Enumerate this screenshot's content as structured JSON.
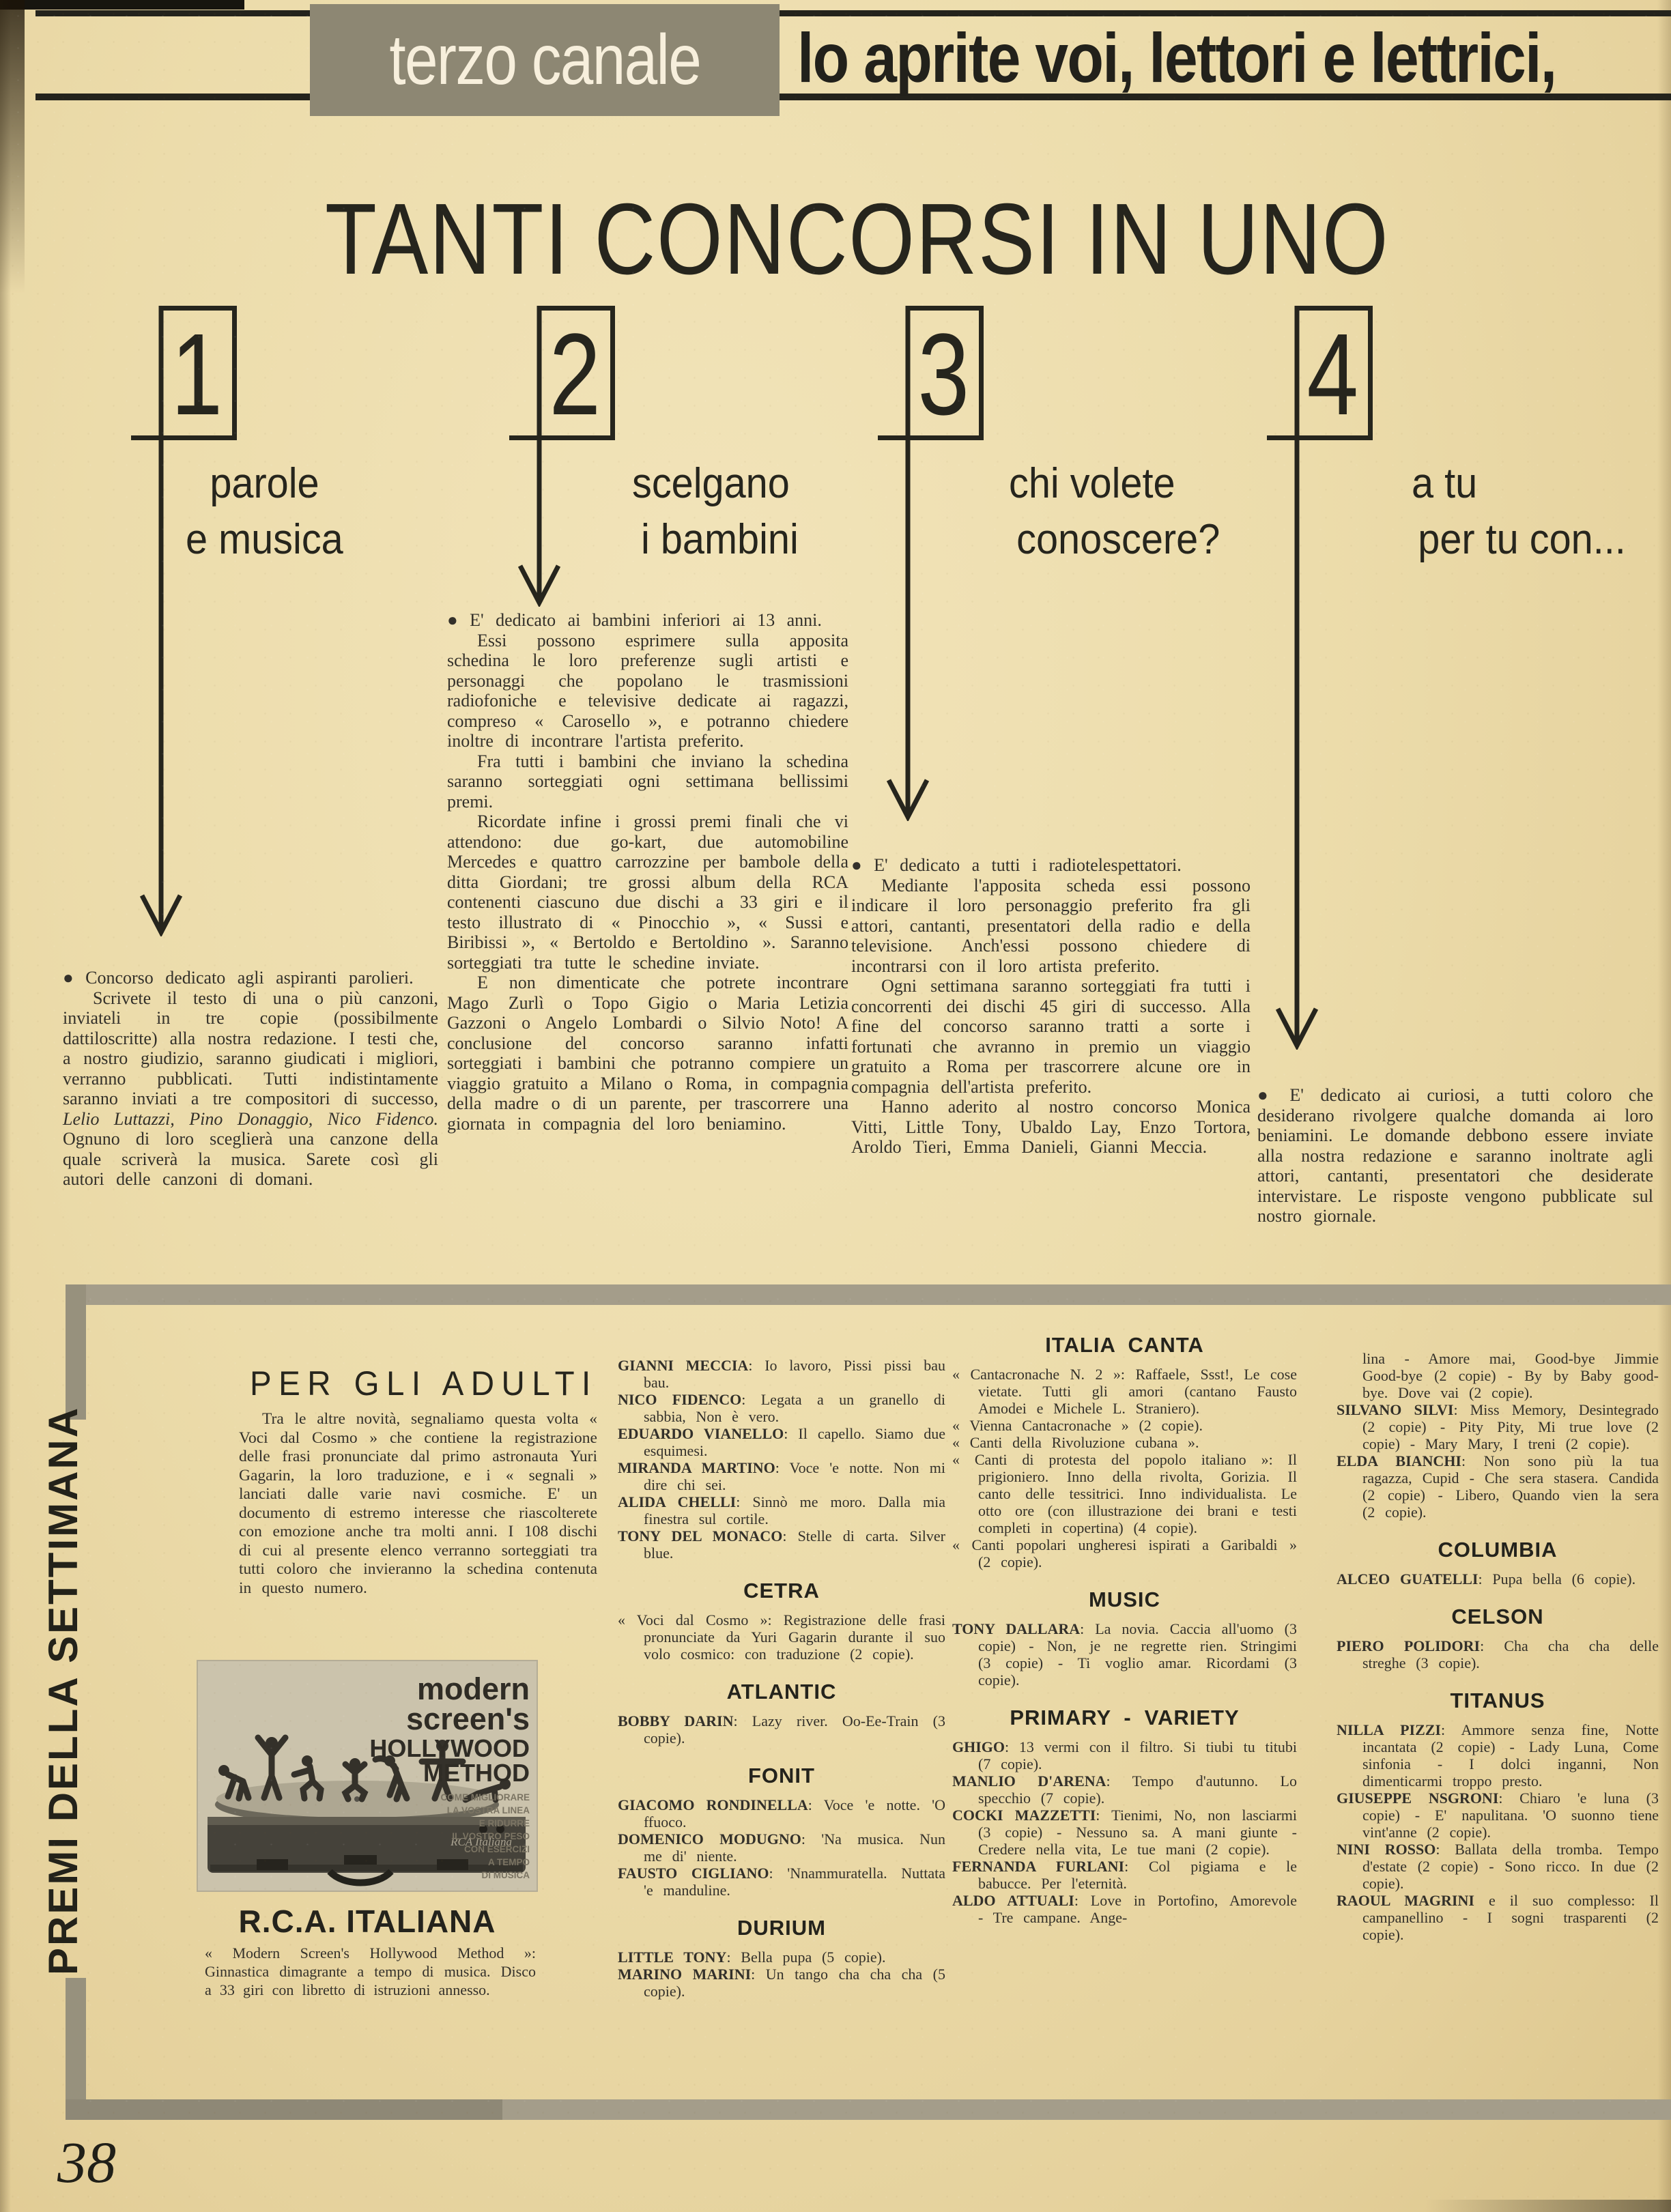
{
  "header": {
    "brand": "terzo canale",
    "tagline": "lo aprite voi, lettori e lettrici,"
  },
  "title": "TANTI CONCORSI IN UNO",
  "concorsi": [
    {
      "number": "1",
      "heading": [
        "parole",
        "e musica"
      ],
      "p1": "●  Concorso dedicato agli aspiranti parolieri.",
      "p2a": "Scrivete il testo di una o più canzoni, inviateli in tre copie (possibilmente dattiloscritte) alla nostra redazione. I testi che, a nostro giudizio, saranno giudicati i migliori, verranno pubblicati. Tutti indistintamente saranno inviati a tre compositori di successo, ",
      "p2i": "Lelio Luttazzi, Pino Donaggio, Nico Fidenco.",
      "p2b": " Ognuno di loro sceglierà una canzone della quale scriverà la musica. Sarete così gli autori delle canzoni di domani."
    },
    {
      "number": "2",
      "heading": [
        "scelgano",
        "i bambini"
      ],
      "paragraphs": [
        "●  E' dedicato ai bambini inferiori ai 13 anni.",
        "Essi possono esprimere sulla apposita schedina le loro preferenze sugli artisti e personaggi che popolano le trasmissioni radiofoniche e televisive dedicate ai ragazzi, compreso « Carosello », e potranno chiedere inoltre di incontrare l'artista preferito.",
        "Fra tutti i bambini che inviano la schedina saranno sorteggiati ogni settimana bellissimi premi.",
        "Ricordate infine i grossi premi finali che vi attendono: due go-kart, due automobiline Mercedes e quattro carrozzine per bambole della ditta Giordani; tre grossi album della RCA contenenti ciascuno due dischi a 33 giri e il testo illustrato di « Pinocchio », « Sussi e Biribissi », « Bertoldo e Bertoldino ». Saranno sorteggiati tra tutte le schedine inviate.",
        "E non dimenticate che potrete incontrare Mago Zurlì o Topo Gigio o Maria Letizia Gazzoni o Angelo Lombardi o Silvio Noto! A conclusione del concorso saranno infatti sorteggiati i bambini che potranno compiere un viaggio gratuito a Milano o Roma, in compagnia della madre o di un parente, per trascorrere una giornata in compagnia del loro beniamino."
      ]
    },
    {
      "number": "3",
      "heading": [
        "chi volete",
        "conoscere?"
      ],
      "paragraphs": [
        "●  E' dedicato a tutti i radiotelespettatori.",
        "Mediante l'apposita scheda essi possono indicare il loro personaggio preferito fra gli attori, cantanti, presentatori della radio e della televisione. Anch'essi possono chiedere di incontrarsi con il loro artista preferito.",
        "Ogni settimana saranno sorteggiati fra tutti i concorrenti dei dischi 45 giri di successo. Alla fine del concorso saranno tratti a sorte i fortunati che avranno in premio un viaggio gratuito a Roma per trascorrere alcune ore in compagnia dell'artista preferito.",
        "Hanno aderito al nostro concorso Monica Vitti, Little Tony, Ubaldo Lay, Enzo Tortora, Aroldo Tieri, Emma Danieli, Gianni Meccia."
      ]
    },
    {
      "number": "4",
      "heading": [
        "a tu",
        "per tu con..."
      ],
      "paragraphs": [
        "●  E' dedicato ai curiosi, a tutti coloro che desiderano rivolgere qualche domanda ai loro beniamini. Le domande debbono essere inviate alla nostra redazione e saranno inoltrate agli attori, cantanti, presentatori che desiderate intervistare. Le risposte vengono pubblicate sul nostro giornale."
      ]
    }
  ],
  "premi": {
    "vertical_title": "PREMI DELLA SETTIMANA",
    "page_number": "38",
    "adulti": {
      "heading": "PER GLI ADULTI",
      "intro": "Tra le altre novità, segnaliamo questa volta « Voci dal Cosmo » che contiene la registrazione delle frasi pronunciate dal primo astronauta Yuri Gagarin, la loro traduzione, e i « segnali » lanciati dalle varie navi cosmiche. E' un documento di estremo interesse che riascolterete con emozione anche tra molti anni. I 108 dischi di cui al presente elenco verranno sorteggiati tra tutti coloro che invieranno la schedina contenuta in questo numero.",
      "cover": {
        "title_lines": [
          "modern",
          "screen's",
          "HOLLYWOOD",
          "METHOD"
        ],
        "subtitle_lines": [
          "COME MIGLIORARE",
          "LA VOSTRA LINEA",
          "E RIDURRE",
          "IL VOSTRO PESO",
          "CON ESERCIZI",
          "A TEMPO",
          "DI MUSICA"
        ],
        "brand_script": "RCA Italiana"
      },
      "label_name": "R.C.A. ITALIANA",
      "caption": "« Modern Screen's Hollywood Method »: Ginnastica dimagrante a tempo di musica. Disco a 33 giri con libretto di istruzioni annesso."
    },
    "col2": {
      "items1": [
        {
          "artist": "GIANNI MECCIA",
          "works": ": Io lavoro, Pissi pissi bau bau."
        },
        {
          "artist": "NICO FIDENCO",
          "works": ": Legata a un granello di sabbia, Non è vero."
        },
        {
          "artist": "EDUARDO VIANELLO",
          "works": ": Il capello. Siamo due esquimesi."
        },
        {
          "artist": "MIRANDA MARTINO",
          "works": ": Voce 'e notte. Non mi dire chi sei."
        },
        {
          "artist": "ALIDA CHELLI",
          "works": ": Sinnò me moro. Dalla mia finestra sul cortile."
        },
        {
          "artist": "TONY DEL MONACO",
          "works": ": Stelle di carta. Silver blue."
        }
      ],
      "h1": "CETRA",
      "items2": [
        {
          "artist": "",
          "works": "« Voci dal Cosmo »: Registrazione delle frasi pronunciate da Yuri Gagarin durante il suo volo cosmico: con traduzione (2 copie)."
        }
      ],
      "h2": "ATLANTIC",
      "items3": [
        {
          "artist": "BOBBY DARIN",
          "works": ": Lazy river. Oo-Ee-Train (3 copie)."
        }
      ],
      "h3": "FONIT",
      "items4": [
        {
          "artist": "GIACOMO RONDINELLA",
          "works": ": Voce 'e notte. 'O ffuoco."
        },
        {
          "artist": "DOMENICO MODUGNO",
          "works": ": 'Na musica. Nun me di' niente."
        },
        {
          "artist": "FAUSTO CIGLIANO",
          "works": ": 'Nnammuratella. Nuttata 'e manduline."
        }
      ],
      "h4": "DURIUM",
      "items5": [
        {
          "artist": "LITTLE TONY",
          "works": ": Bella pupa (5 copie)."
        },
        {
          "artist": "MARINO MARINI",
          "works": ": Un tango cha cha cha (5 copie)."
        }
      ]
    },
    "col3": {
      "h1": "ITALIA CANTA",
      "items1": [
        {
          "artist": "",
          "works": "« Cantacronache N. 2 »: Raffaele, Ssst!, Le cose vietate. Tutti gli amori (cantano Fausto Amodei e Michele L. Straniero)."
        },
        {
          "artist": "",
          "works": "« Vienna Cantacronache » (2 copie)."
        },
        {
          "artist": "",
          "works": "« Canti della Rivoluzione cubana »."
        },
        {
          "artist": "",
          "works": "« Canti di protesta del popolo italiano »: Il prigioniero. Inno della rivolta, Gorizia. Il canto delle tessitrici. Inno individualista. Le otto ore (con illustrazione dei brani e testi completi in copertina) (4 copie)."
        },
        {
          "artist": "",
          "works": "« Canti popolari ungheresi ispirati a Garibaldi » (2 copie)."
        }
      ],
      "h2": "MUSIC",
      "items2": [
        {
          "artist": "TONY DALLARA",
          "works": ": La novia. Caccia all'uomo (3 copie) - Non, je ne regrette rien. Stringimi (3 copie) - Ti voglio amar. Ricordami (3 copie)."
        }
      ],
      "h3": "PRIMARY - VARIETY",
      "items3": [
        {
          "artist": "GHIGO",
          "works": ": 13 vermi con il filtro. Si tiubi tu titubi (7 copie)."
        },
        {
          "artist": "MANLIO D'ARENA",
          "works": ": Tempo d'autunno. Lo specchio (7 copie)."
        },
        {
          "artist": "COCKI MAZZETTI",
          "works": ": Tienimi, No, non lasciarmi (3 copie) - Nessuno sa. A mani giunte - Credere nella vita, Le tue mani (2 copie)."
        },
        {
          "artist": "FERNANDA FURLANI",
          "works": ": Col pigiama e le babucce. Per l'eternità."
        },
        {
          "artist": "ALDO ATTUALI",
          "works": ": Love in Portofino, Amorevole - Tre campane. Ange-"
        }
      ]
    },
    "col4": {
      "items1": [
        {
          "artist": "",
          "works": "lina - Amore mai, Good-bye Jimmie Good-bye (2 copie) - By by Baby good-bye. Dove vai (2 copie)."
        },
        {
          "artist": "SILVANO SILVI",
          "works": ": Miss Memory, Desintegrado (2 copie) - Pity Pity, Mi true love (2 copie) - Mary Mary, I treni (2 copie)."
        },
        {
          "artist": "ELDA BIANCHI",
          "works": ": Non sono più la tua ragazza, Cupid - Che sera stasera. Candida (2 copie) - Libero, Quando vien la sera (2 copie)."
        }
      ],
      "h1": "COLUMBIA",
      "items2": [
        {
          "artist": "ALCEO GUATELLI",
          "works": ": Pupa bella (6 copie)."
        }
      ],
      "h2": "CELSON",
      "items3": [
        {
          "artist": "PIERO POLIDORI",
          "works": ": Cha cha cha delle streghe (3 copie)."
        }
      ],
      "h3": "TITANUS",
      "items4": [
        {
          "artist": "NILLA PIZZI",
          "works": ": Ammore senza fine, Notte incantata (2 copie) - Lady Luna, Come sinfonia - I dolci inganni, Non dimenticarmi troppo presto."
        },
        {
          "artist": "GIUSEPPE NSGRONI",
          "works": ": Chiaro 'e luna (3 copie) - E' napulitana. 'O suonno tiene vint'anne (2 copie)."
        },
        {
          "artist": "NINI ROSSO",
          "works": ": Ballata della tromba. Tempo d'estate (2 copie) - Sono ricco. In due (2 copie)."
        },
        {
          "artist": "RAOUL MAGRINI",
          "works": " e il suo complesso: Il campanellino - I sogni trasparenti (2 copie)."
        }
      ]
    }
  }
}
